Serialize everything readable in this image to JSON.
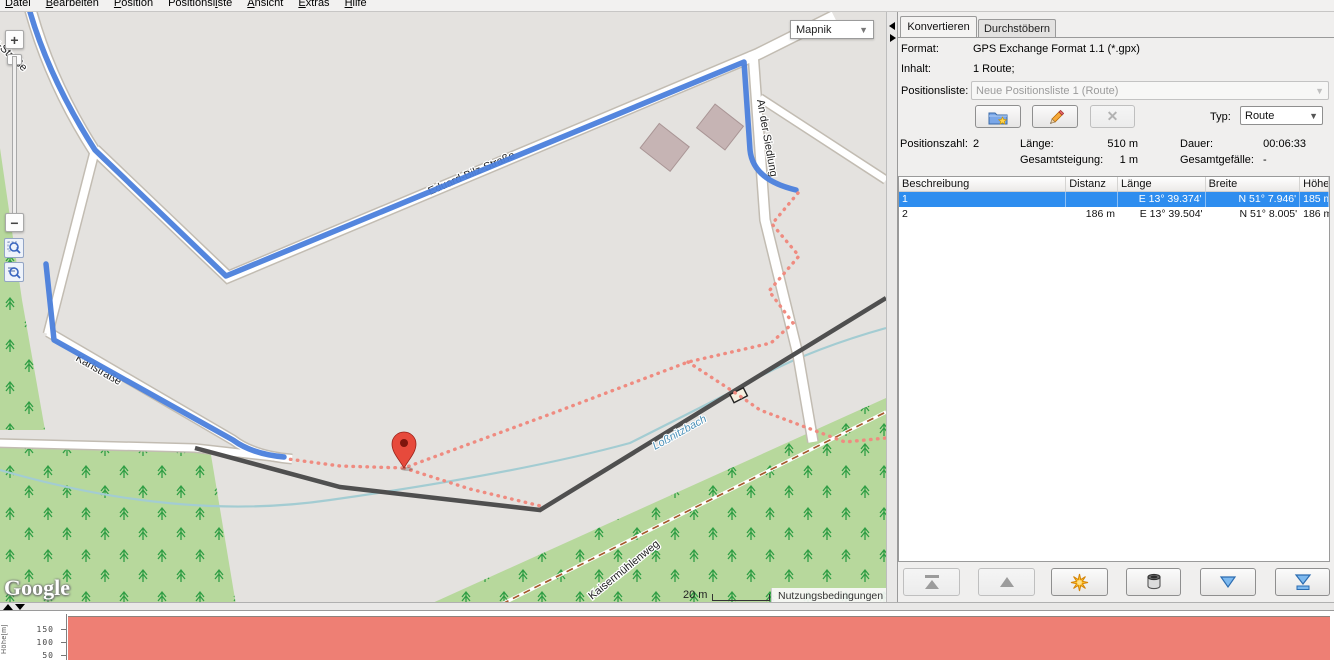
{
  "menu": {
    "items": [
      {
        "pre": "",
        "key": "D",
        "post": "atei"
      },
      {
        "pre": "",
        "key": "B",
        "post": "earbeiten"
      },
      {
        "pre": "",
        "key": "P",
        "post": "osition"
      },
      {
        "pre": "Positionsl",
        "key": "i",
        "post": "ste"
      },
      {
        "pre": "",
        "key": "A",
        "post": "nsicht"
      },
      {
        "pre": "",
        "key": "E",
        "post": "xtras"
      },
      {
        "pre": "",
        "key": "H",
        "post": "ilfe"
      }
    ]
  },
  "map": {
    "layer_select": "Mapnik",
    "controls": {
      "zoom_in": "+",
      "zoom_out": "−"
    },
    "labels": {
      "bilz": "Bilz-Straße",
      "eduard": "Eduard-Bilz-Straße",
      "siedlung": "An der Siedlung",
      "karl": "Karlstraße",
      "kaiser": "Kaisermühlenweg",
      "stream": "Loßnitzbach"
    },
    "scale_label": "20 m",
    "attribution": "Nutzungsbedingungen",
    "logo": "Google"
  },
  "panel": {
    "tabs": [
      {
        "label": "Konvertieren",
        "active": true
      },
      {
        "label": "Durchstöbern",
        "active": false
      }
    ],
    "format_label": "Format:",
    "format_value": "GPS Exchange Format 1.1 (*.gpx)",
    "content_label": "Inhalt:",
    "content_value": "1 Route;",
    "list_label": "Positionsliste:",
    "list_value": "Neue Positionsliste 1 (Route)",
    "type_label": "Typ:",
    "type_value": "Route",
    "stats": {
      "count_label": "Positionszahl:",
      "count": "2",
      "length_label": "Länge:",
      "length": "510 m",
      "duration_label": "Dauer:",
      "duration": "00:06:33",
      "ascent_label": "Gesamtsteigung:",
      "ascent": "1 m",
      "descent_label": "Gesamtgefälle:",
      "descent": "-"
    },
    "table": {
      "columns": [
        "Beschreibung",
        "Distanz",
        "Länge",
        "Breite",
        "Höhe"
      ],
      "rows": [
        {
          "selected": true,
          "cells": [
            "1",
            "",
            "E 13° 39.374'",
            "N 51° 7.946'",
            "185 m"
          ]
        },
        {
          "selected": false,
          "cells": [
            "2",
            "186 m",
            "E 13° 39.504'",
            "N 51° 8.005'",
            "186 m"
          ]
        }
      ]
    }
  },
  "profile": {
    "ylabel": "Höhe[m]",
    "yticks": [
      "150",
      "100",
      "50"
    ]
  },
  "chart_data": {
    "type": "area",
    "title": "",
    "xlabel": "",
    "ylabel": "Höhe[m]",
    "ytick_values": [
      50,
      100,
      150
    ],
    "x_m": [
      0,
      186
    ],
    "elevation_m": [
      185,
      186
    ],
    "fill_color": "#ee7f74",
    "note": "elevation profile of the 2-point route; flat fill visible, bottom clipped by window edge"
  },
  "colors": {
    "selection_blue": "#2e8def",
    "route_blue": "#4b80dc",
    "route_dots_salmon": "#ef8b80",
    "profile_fill": "#ee7f74",
    "map_green": "#b7d89c",
    "map_gray": "#e4e2df",
    "marker_red": "#e74a3c"
  }
}
